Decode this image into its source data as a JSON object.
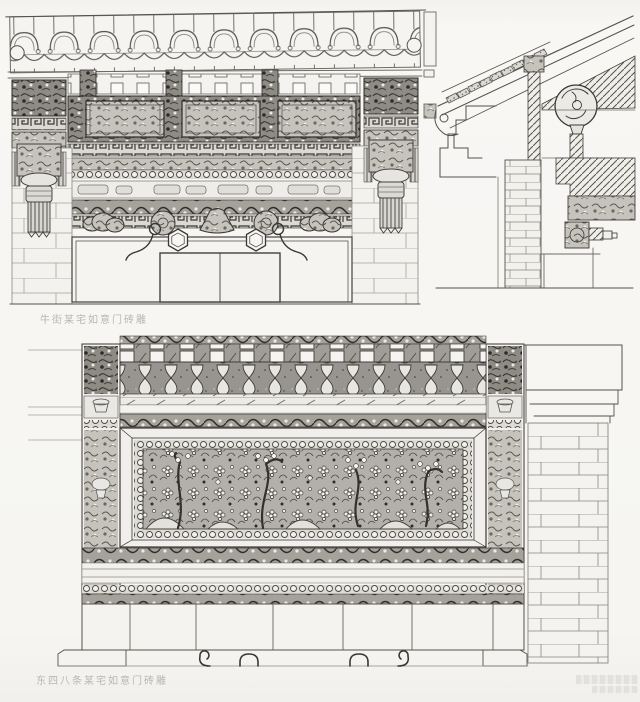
{
  "page": {
    "background_color": "#f6f5f2",
    "ink_color": "#44423d",
    "caption_color": "#aeaca8",
    "type_note": "scanned book page with architectural line drawings of Beijing ruyi-gate brick carvings"
  },
  "figures": {
    "top_elevation_caption": "牛街某宅如意门砖雕",
    "bottom_elevation_caption": "东四八条某宅如意门砖雕"
  }
}
